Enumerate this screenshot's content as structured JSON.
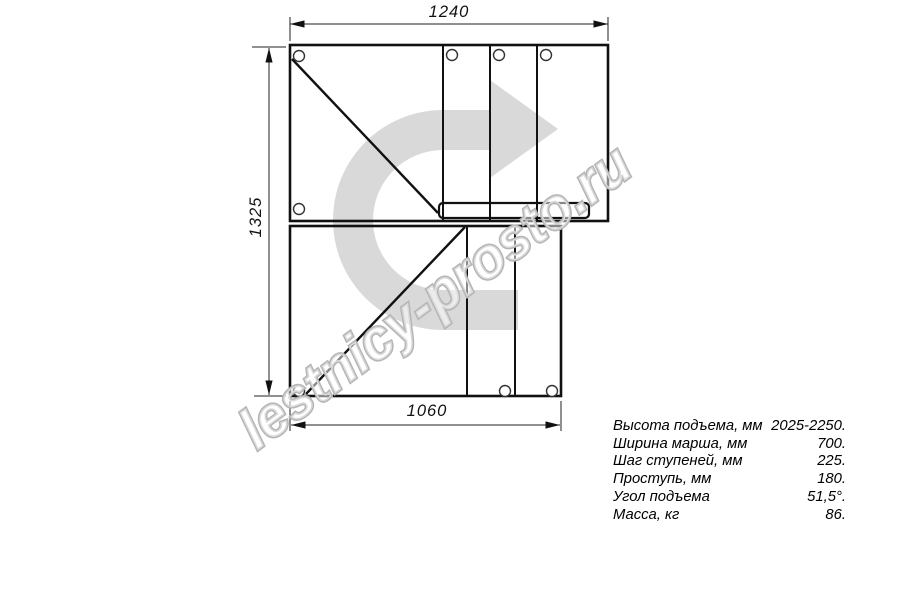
{
  "watermark": {
    "text": "lestnicy-prosto.ru",
    "arrow_icon": "rotate-right-arrow"
  },
  "dimensions": {
    "top_width": "1240",
    "left_height": "1325",
    "bottom_width": "1060"
  },
  "specs": {
    "rows": [
      {
        "label": "Высота подъема, мм",
        "value": "2025-2250."
      },
      {
        "label": "Ширина марша, мм",
        "value": "700."
      },
      {
        "label": "Шаг ступеней, мм",
        "value": "225."
      },
      {
        "label": "Проступь, мм",
        "value": "180."
      },
      {
        "label": "Угол подъема",
        "value": "51,5°."
      },
      {
        "label": "Масса, кг",
        "value": "86."
      }
    ]
  },
  "colors": {
    "line": "#111111",
    "dim_line": "#222222",
    "watermark_arrow_fill": "#d9d9d9",
    "watermark_text_outline": "#b5b5b5"
  }
}
